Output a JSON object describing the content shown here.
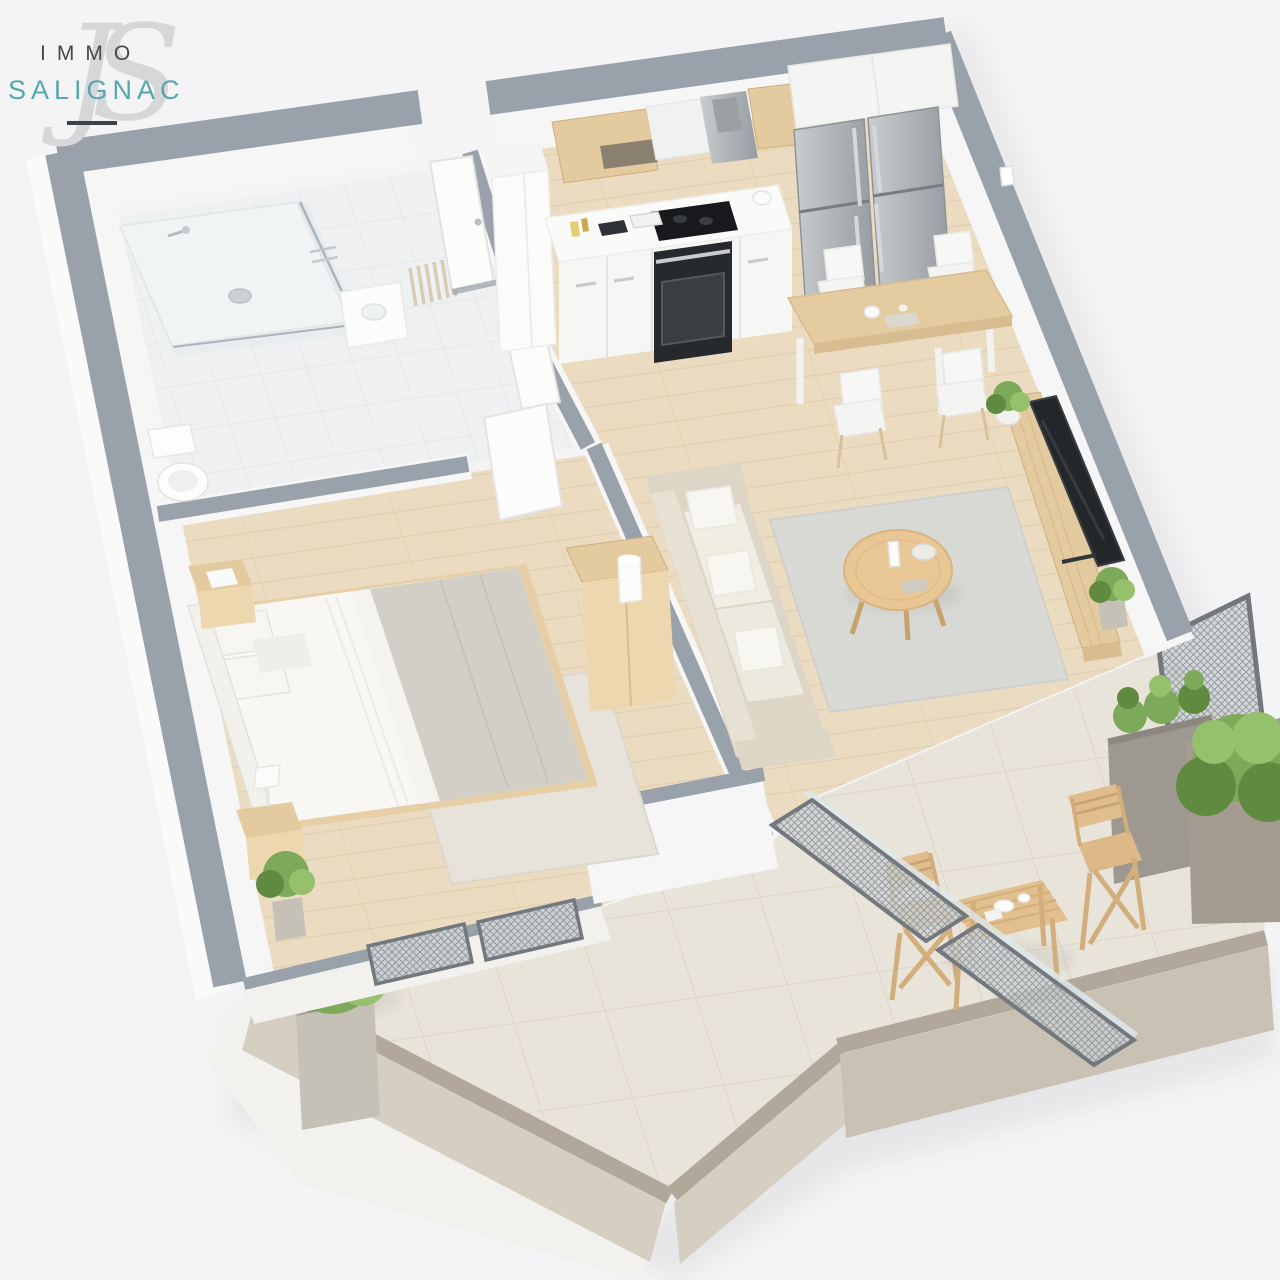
{
  "logo": {
    "line1": "IMMO",
    "line2": "SALIGNAC",
    "monogram": "JS"
  },
  "palette": {
    "bg": "#f4f4f6",
    "wallTop": "#99a1aa",
    "wallWhite": "#f6f6f7",
    "wallFace": "#f2f1ee",
    "woodFloor": "#ebdcc1",
    "woodLine": "#d9c6a6",
    "bathFloor": "#eef0f1",
    "bathLine": "#dfe4e6",
    "terraceFloor": "#e9e4da",
    "terraceLine": "#d9d3c6",
    "parapetTop": "#b1a89b",
    "parapetFaceLight": "#d5cec1",
    "parapetFace": "#c9c1b3",
    "outerSlab": "#fafafb",
    "rugLiving": "#d8d8d4",
    "rugBedroom": "#e7e3da",
    "sofaBody": "#ddd5c5",
    "sofaBack": "#e7e1d3",
    "cushionLight": "#f0eee2",
    "pillowWhite": "#f8f6f0",
    "woodFurn": "#e4cb9f",
    "woodFurnFront": "#ecd7ae",
    "woodDark": "#cfae7c",
    "tableWood": "#e5cba0",
    "steelA": "#c9ccce",
    "steelB": "#969ca1",
    "applianceDark": "#17191c",
    "ovenFace": "#26292d",
    "tvDark": "#24272a",
    "plantGreen": "#7da95a",
    "plantDark": "#5f8a3f",
    "plantLight": "#95c06c",
    "planterGray": "#9d9890",
    "potGray": "#c6c1b7",
    "meshFill": "#ccd0d2",
    "frameDark": "#73787e",
    "glass": "#dfe9ed",
    "bedSheet": "#f8f7f4",
    "bedBlanket": "#d2cfc7",
    "headboard": "#f2f0eb",
    "shadow": "#d9d9dd",
    "logoDark": "#48484a",
    "logoTeal": "#58a7ab",
    "logoRule": "#3d4449",
    "monogram": "#d7d7da"
  },
  "scene": {
    "type": "3d-floor-plan-render",
    "view": "isometric cutaway, one-bedroom apartment with wrap-around terrace",
    "rooms": [
      {
        "name": "bathroom",
        "furniture": [
          "walk-in-shower",
          "glass-screen",
          "floor-drain",
          "toilet",
          "vanity",
          "towel-rack"
        ]
      },
      {
        "name": "entry-hall",
        "furniture": [
          "entrance-door",
          "tall-closet"
        ]
      },
      {
        "name": "kitchen",
        "furniture": [
          "upper-cabinets",
          "range-hood",
          "cooktop",
          "oven",
          "base-cabinets",
          "counter-accessories",
          "double-fridge-freezer"
        ]
      },
      {
        "name": "dining-area",
        "furniture": [
          "dining-table",
          "chair",
          "chair",
          "chair",
          "chair",
          "centerpiece"
        ]
      },
      {
        "name": "living-room",
        "furniture": [
          "sofa",
          "throw-pillows",
          "area-rug",
          "round-coffee-table",
          "tv",
          "media-bench",
          "potted-plant",
          "potted-plant"
        ]
      },
      {
        "name": "bedroom",
        "furniture": [
          "double-bed",
          "headboard",
          "pillows",
          "nightstand",
          "nightstand",
          "table-lamp",
          "sideboard",
          "lamp",
          "area-rug",
          "potted-plant"
        ]
      },
      {
        "name": "terrace",
        "furniture": [
          "bistro-table",
          "wooden-chair",
          "wooden-chair",
          "privacy-screen",
          "planter-box",
          "planter-box",
          "planter-box",
          "parapet-wall"
        ]
      }
    ]
  }
}
